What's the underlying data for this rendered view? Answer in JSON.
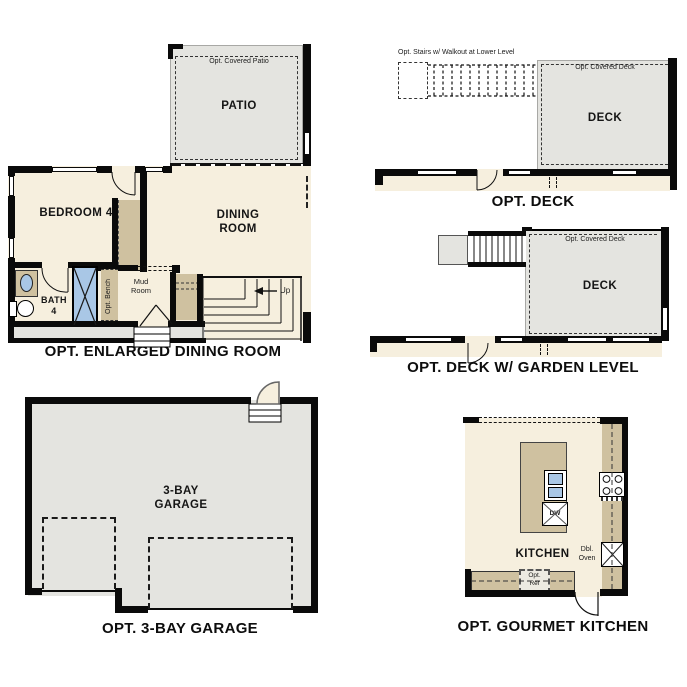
{
  "colors": {
    "wall": "#0a0a0a",
    "floor_beige": "#f6efde",
    "hardscape_gray": "#e4e4e0",
    "cabinet_tan": "#cfc1a0",
    "fixture_blue": "#a9c7e6",
    "background": "#ffffff"
  },
  "plans": {
    "enlarged_dining": {
      "title": "OPT. ENLARGED DINING ROOM",
      "patio_label": "PATIO",
      "covered_patio_note": "Opt. Covered Patio",
      "slider_note": "Opt. 12' Stacking Slider Door",
      "bedroom_label": "BEDROOM 4",
      "dining_label": "DINING\nROOM",
      "bath_label": "BATH\n4",
      "mud_label": "Mud\nRoom",
      "bench_note": "Opt. Bench",
      "up_label": "Up"
    },
    "deck": {
      "title": "OPT. DECK",
      "stairs_note": "Opt. Stairs w/ Walkout at Lower Level",
      "covered_note": "Opt. Covered Deck",
      "deck_label": "DECK"
    },
    "deck_garden": {
      "title": "OPT. DECK W/ GARDEN LEVEL",
      "covered_note": "Opt. Covered Deck",
      "deck_label": "DECK"
    },
    "garage": {
      "title": "OPT. 3-BAY GARAGE",
      "room_label": "3-BAY\nGARAGE"
    },
    "gourmet_kitchen": {
      "title": "OPT. GOURMET KITCHEN",
      "room_label": "KITCHEN",
      "dw_label": "DW",
      "dbl_oven_label": "Dbl.\nOven",
      "opt_ref_label": "Opt.\nRef"
    }
  }
}
